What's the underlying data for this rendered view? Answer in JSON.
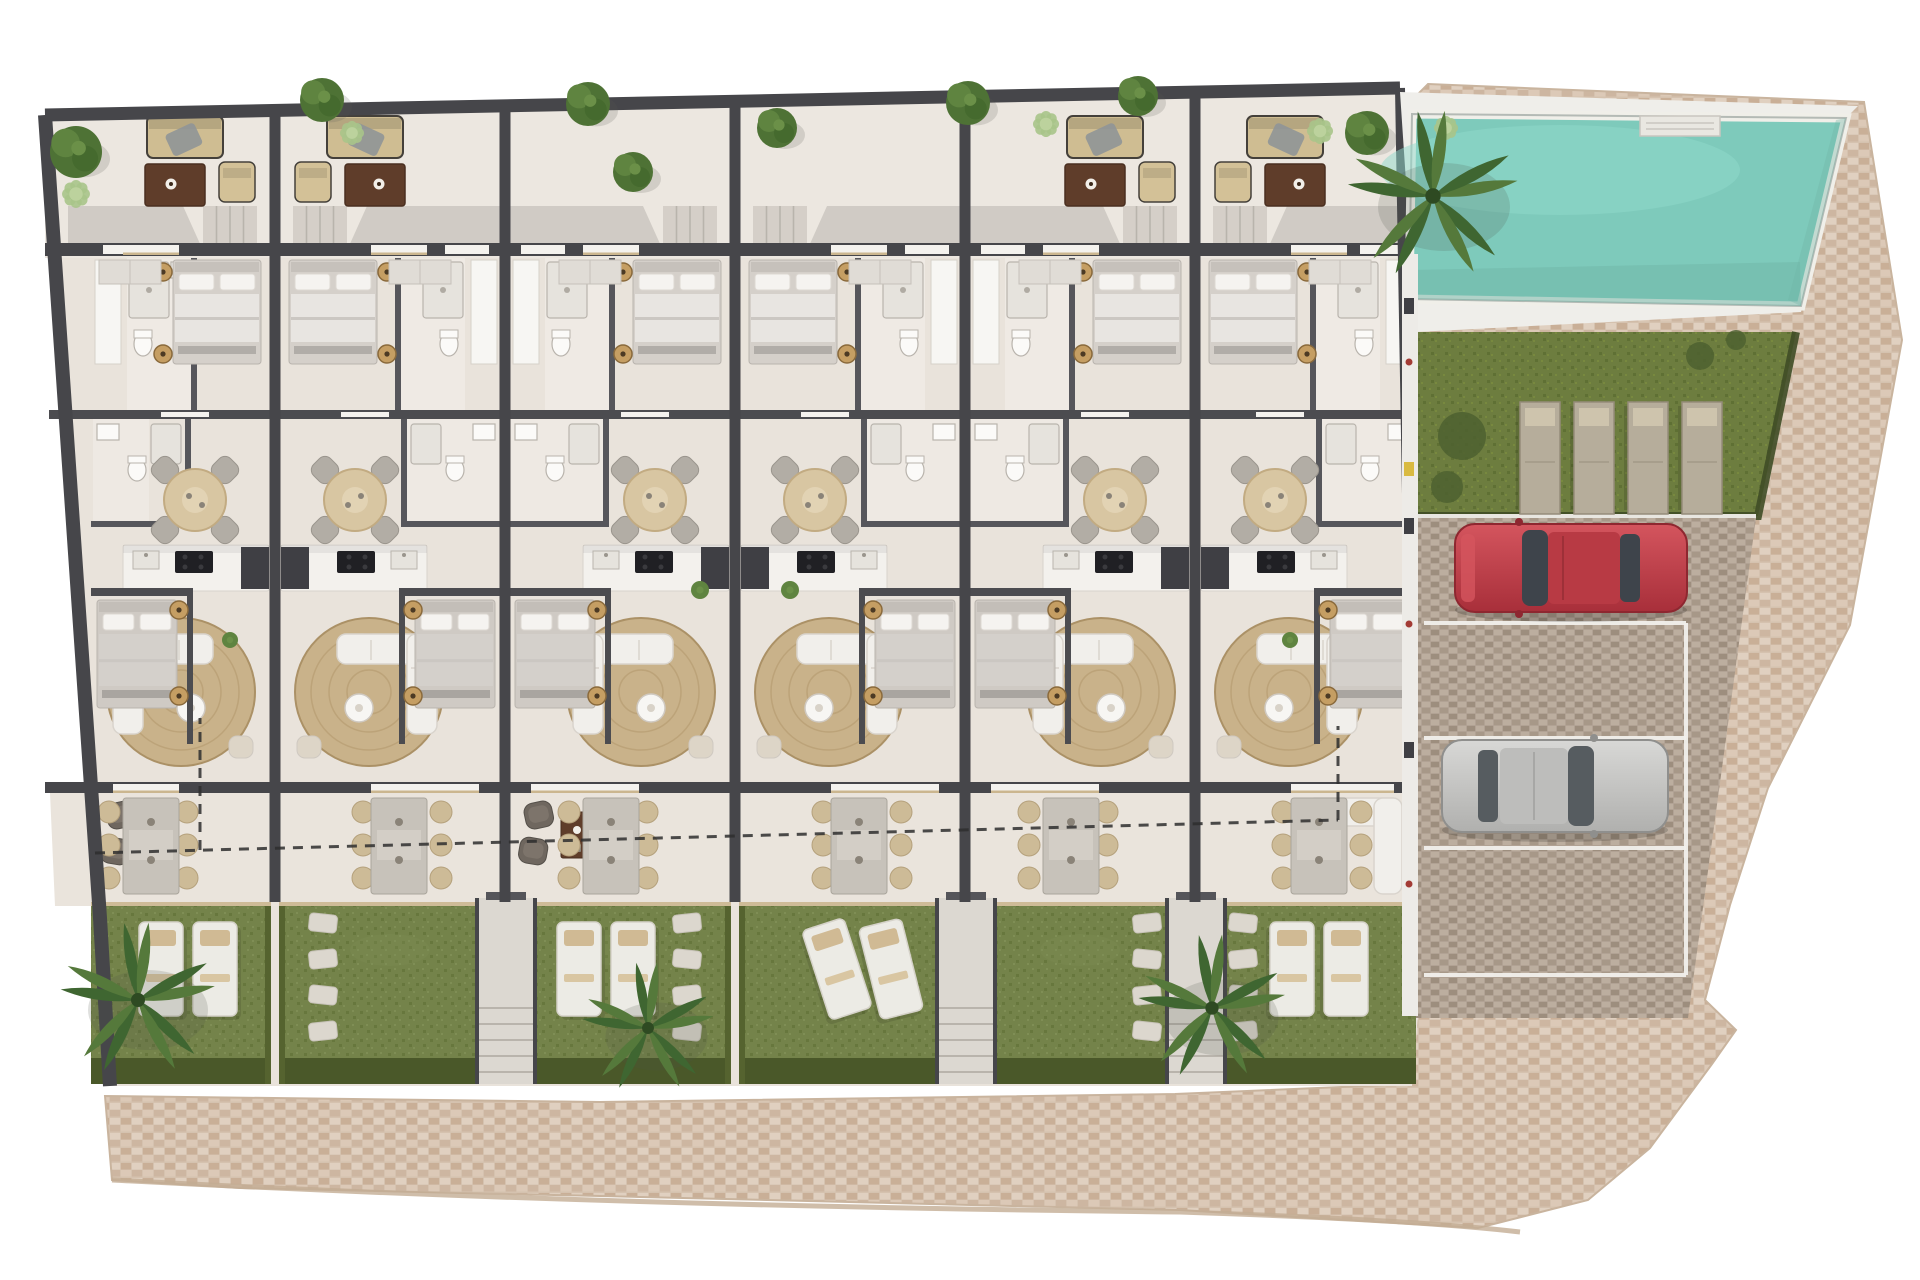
{
  "meta": {
    "type": "architectural-site-plan-render",
    "canvas": {
      "w": 1920,
      "h": 1280
    },
    "units_count": 6,
    "parking_bays": 4,
    "cars_visible": [
      "red-car",
      "silver-car"
    ],
    "pool_count": 1
  },
  "palette": {
    "bg": "#ffffff",
    "wall": "#46464a",
    "wall_light": "#56565b",
    "floor": "#e9e3db",
    "terrace": "#ece7e0",
    "lower_terrace": "#eae4dc",
    "shade": "rgba(110,106,100,0.22)",
    "cobble_base": "#d5c2af",
    "cobble_a": "#cdb6a1",
    "cobble_b": "#dcc9b7",
    "cobble_c": "#e0d0c0",
    "cobble_d": "#c9af97",
    "cobble_edge": "#c3ad94",
    "paver_base": "#b1a294",
    "paver_a": "#a79888",
    "paver_b": "#bcae9f",
    "paver_c": "#9d8e7e",
    "pool_water": "#7ecabb",
    "pool_water_light": "#8fdacb",
    "pool_water_dark": "#6fb5a7",
    "pool_deck": "#efeeea",
    "lawn_base": "#6d7d3f",
    "lawn_dark": "#5f7034",
    "grass_base": "#74834a",
    "grass_dark": "#67773d",
    "grass_light": "#7f8e55",
    "hedge": "#4a5829",
    "hedge_side": "#55632f",
    "white_line": "#f2f0ec",
    "lounger_white": "#ecebe5",
    "lounger_tan": "#d0ba94",
    "lounger_gray": "#b6ad9b",
    "lounger_gray_pad": "#cec4ad",
    "car_red": "#c6414b",
    "car_red_dark": "#b23641",
    "car_glass": "#3e444b",
    "car_silver": "#c9c8c5",
    "car_silver_dark": "#a7a7a5",
    "tree_dark": "#4e7235",
    "tree_mid": "#5f8440",
    "bush_light": "#a9c489",
    "palm_a": "#3f6631",
    "palm_b": "#55793b",
    "rug": "#c9b28a",
    "rug_ring": "#b99f74",
    "sofa_white": "#f1efeb",
    "sofa_line": "#d9d4cd",
    "table_beige": "#d8c6a2",
    "chair_gray": "#b2ada5",
    "table_gray": "#c7c2ba",
    "chair_tan": "#cdbb97",
    "terrace_sofa": "#cfbd92",
    "terrace_table": "#5f3d2a",
    "kitchen_black": "#202024",
    "appliance": "#3f3f44",
    "counter": "#f3f1ed",
    "fixture": "#fbfaf8",
    "fixture_line": "#b9b4ad",
    "stone": "#dcd7ce",
    "wood_edge": "#cbb68f",
    "steps": "#d2cdc6",
    "step_line": "#b9b4ac",
    "dash": "#2e2e2e",
    "passage": "#edebe7",
    "accent_yellow": "#d9ba41",
    "accent_red": "#a33b35"
  },
  "site": {
    "cobble_path": [
      [
        1428,
        84
      ],
      [
        1864,
        102
      ],
      [
        1902,
        340
      ],
      [
        1850,
        625
      ],
      [
        1768,
        788
      ],
      [
        1730,
        905
      ],
      [
        1705,
        1000
      ],
      [
        1736,
        1030
      ],
      [
        1712,
        1064
      ],
      [
        1650,
        1148
      ],
      [
        1588,
        1200
      ],
      [
        1478,
        1228
      ],
      [
        1180,
        1210
      ],
      [
        600,
        1196
      ],
      [
        240,
        1188
      ],
      [
        112,
        1180
      ],
      [
        105,
        1096
      ],
      [
        600,
        1102
      ],
      [
        1175,
        1094
      ],
      [
        1412,
        1084
      ],
      [
        1416,
        96
      ]
    ],
    "building_floor": [
      [
        45,
        115
      ],
      [
        1400,
        88
      ],
      [
        1412,
        560
      ],
      [
        1418,
        1016
      ],
      [
        1412,
        1086
      ],
      [
        110,
        1086
      ],
      [
        100,
        918
      ]
    ],
    "terrace_strip": [
      [
        45,
        115
      ],
      [
        1400,
        88
      ],
      [
        1400,
        258
      ],
      [
        45,
        258
      ]
    ],
    "lower_terrace_strip": [
      [
        50,
        793
      ],
      [
        1414,
        793
      ],
      [
        1414,
        906
      ],
      [
        55,
        906
      ]
    ],
    "outer_wall_top": [
      [
        45,
        115
      ],
      [
        1400,
        88
      ]
    ],
    "outer_wall_left": [
      [
        45,
        115
      ],
      [
        100,
        918
      ],
      [
        110,
        1086
      ]
    ],
    "outer_wall_right": [
      [
        1400,
        88
      ],
      [
        1416,
        1016
      ]
    ],
    "unit_walls_x": [
      275,
      505,
      735,
      965,
      1195
    ],
    "garden_band": {
      "y0": 902,
      "y1": 1084
    },
    "bottom_edge_curve": "M112,1180 Q600,1206 1180,1212 Q1420,1220 1520,1232"
  },
  "units": [
    {
      "x0": 45,
      "x1": 275,
      "mirror": false,
      "indent": 42,
      "terrace_set": true,
      "lower": "armchairs",
      "loungers": true,
      "angled": false,
      "stones": false
    },
    {
      "x0": 275,
      "x1": 505,
      "mirror": true,
      "indent": 0,
      "terrace_set": true,
      "lower": "dining",
      "loungers": false,
      "angled": false,
      "stones": true
    },
    {
      "x0": 505,
      "x1": 735,
      "mirror": false,
      "indent": 0,
      "terrace_set": false,
      "lower": "armchairs",
      "loungers": true,
      "angled": false,
      "stones": true
    },
    {
      "x0": 735,
      "x1": 965,
      "mirror": true,
      "indent": 0,
      "terrace_set": false,
      "lower": "dining",
      "loungers": true,
      "angled": true,
      "stones": false
    },
    {
      "x0": 965,
      "x1": 1195,
      "mirror": false,
      "indent": 0,
      "terrace_set": true,
      "lower": "dining",
      "loungers": false,
      "angled": false,
      "stones": true
    },
    {
      "x0": 1195,
      "x1": 1420,
      "mirror": true,
      "indent": 0,
      "terrace_set": true,
      "lower": "sofaL",
      "loungers": true,
      "angled": false,
      "stones": true
    }
  ],
  "walkways": [
    506,
    966,
    1196
  ],
  "right_wing": {
    "deck": [
      [
        1400,
        92
      ],
      [
        1858,
        106
      ],
      [
        1846,
        118
      ],
      [
        1801,
        312
      ],
      [
        1416,
        332
      ]
    ],
    "pool": [
      [
        1412,
        114
      ],
      [
        1846,
        118
      ],
      [
        1801,
        306
      ],
      [
        1409,
        299
      ]
    ],
    "pool_steps": {
      "x": 1640,
      "y": 116,
      "w": 80,
      "h": 20
    },
    "lawn": [
      [
        1416,
        332
      ],
      [
        1796,
        332
      ],
      [
        1758,
        516
      ],
      [
        1416,
        516
      ]
    ],
    "lawn_loungers": [
      [
        1520,
        402
      ],
      [
        1574,
        402
      ],
      [
        1628,
        402
      ],
      [
        1682,
        402
      ]
    ],
    "lawn_bushes": [
      [
        1462,
        436,
        24
      ],
      [
        1447,
        487,
        16
      ],
      [
        1700,
        356,
        14
      ],
      [
        1736,
        340,
        10
      ]
    ],
    "parking": [
      [
        1416,
        518
      ],
      [
        1756,
        518
      ],
      [
        1688,
        1018
      ],
      [
        1416,
        1018
      ]
    ],
    "bay_lines_y": [
      623,
      738,
      848,
      975
    ],
    "bay_right_x": 1686,
    "bay_left_x": 1424,
    "passage": {
      "x": 1402,
      "y": 254,
      "w": 16,
      "h": 762
    },
    "red_car": {
      "x": 1455,
      "y": 524,
      "w": 232,
      "h": 88
    },
    "silver_car": {
      "x": 1442,
      "y": 740,
      "w": 226,
      "h": 92
    }
  },
  "vegetation": {
    "trees_dark": [
      [
        76,
        152,
        26
      ],
      [
        322,
        100,
        22
      ],
      [
        588,
        104,
        22
      ],
      [
        633,
        172,
        20
      ],
      [
        777,
        128,
        20
      ],
      [
        968,
        103,
        22
      ],
      [
        1138,
        96,
        20
      ],
      [
        1367,
        133,
        22
      ]
    ],
    "bushes_light": [
      [
        76,
        194,
        15
      ],
      [
        352,
        133,
        13
      ],
      [
        1046,
        124,
        14
      ],
      [
        1320,
        131,
        14
      ],
      [
        1446,
        128,
        13
      ]
    ],
    "palms": [
      [
        138,
        1000,
        1.0
      ],
      [
        648,
        1028,
        0.85
      ],
      [
        1212,
        1008,
        0.95
      ],
      [
        1433,
        196,
        1.1
      ]
    ],
    "indoor_plants": [
      [
        700,
        590,
        9
      ],
      [
        790,
        590,
        9
      ],
      [
        230,
        640,
        8
      ],
      [
        1290,
        640,
        8
      ]
    ]
  },
  "dashed_boundary": {
    "main": [
      [
        95,
        853
      ],
      [
        1338,
        820
      ]
    ],
    "left_riser": [
      [
        200,
        850
      ],
      [
        200,
        718
      ]
    ],
    "right_riser": [
      [
        1338,
        820
      ],
      [
        1338,
        726
      ]
    ]
  }
}
